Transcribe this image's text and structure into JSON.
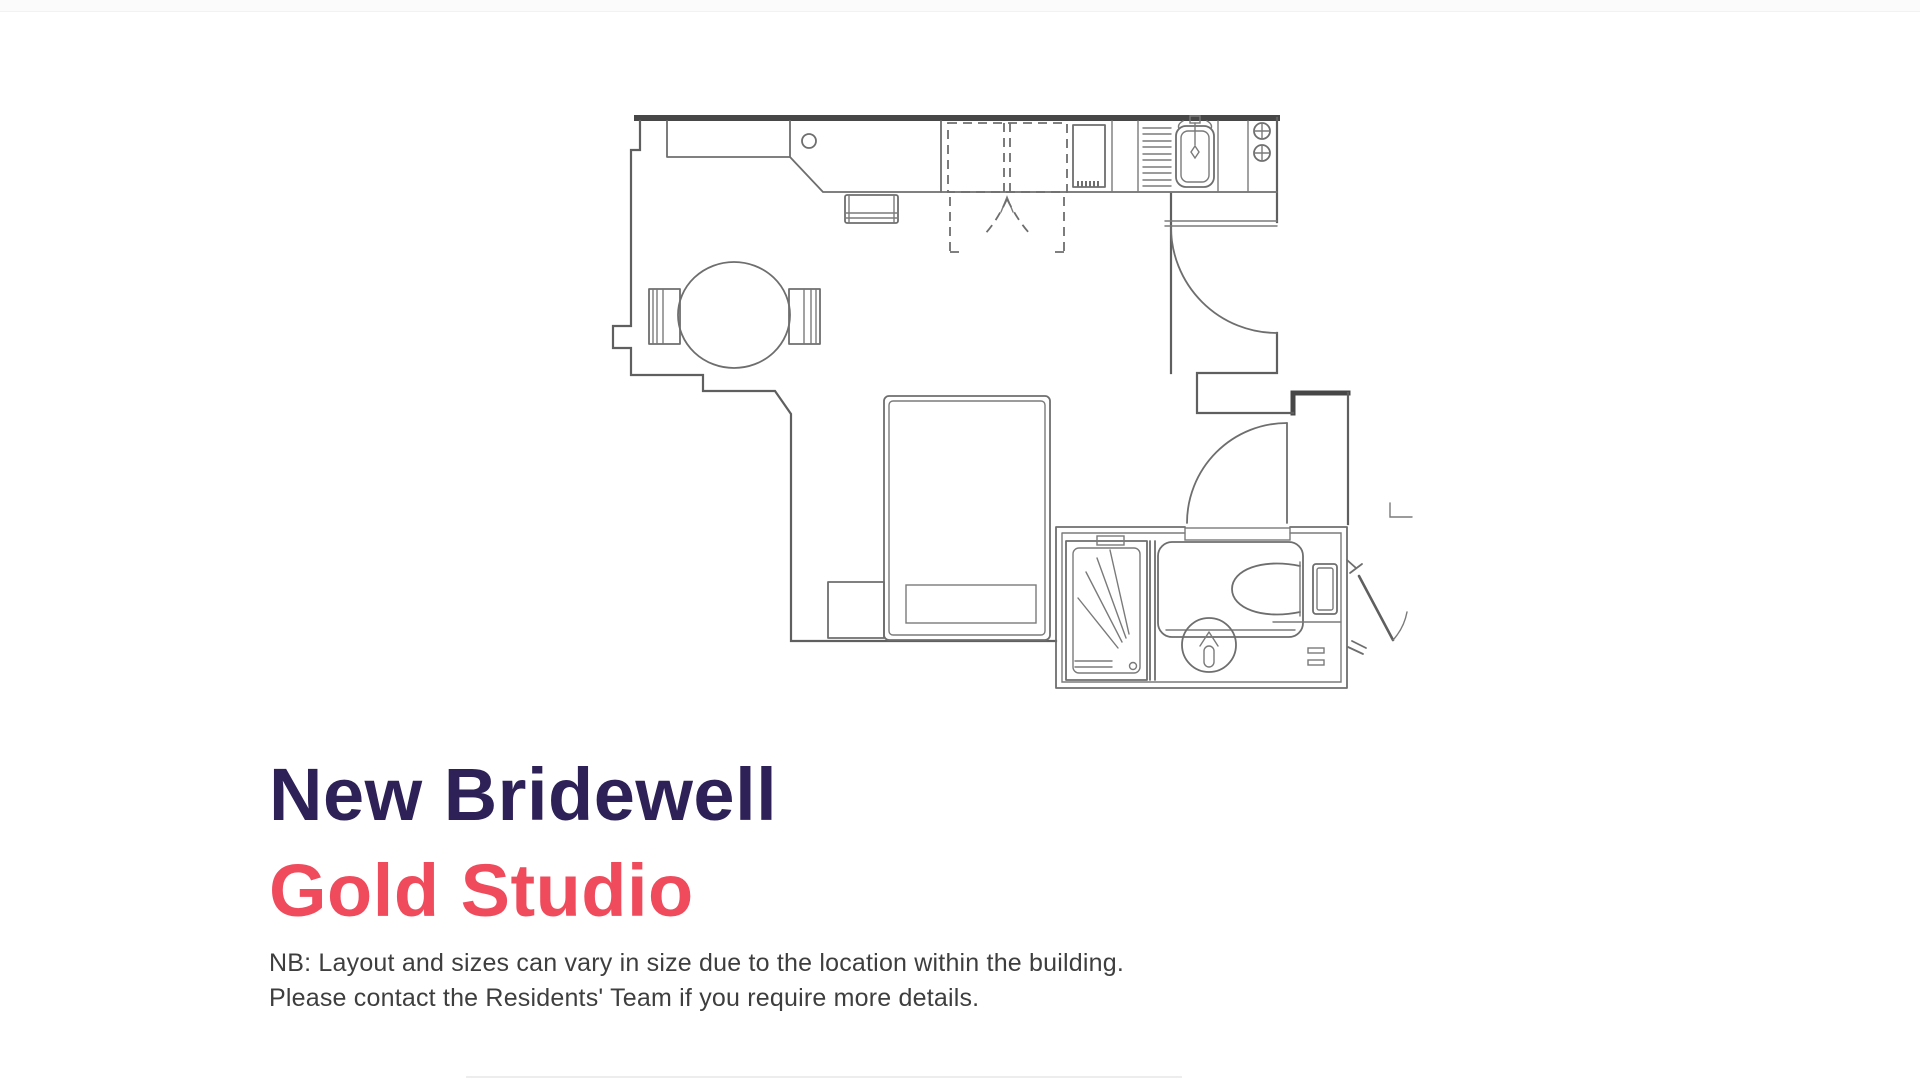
{
  "heading": {
    "building": "New Bridewell",
    "unit": "Gold Studio"
  },
  "note": {
    "line1": "NB: Layout and sizes can vary in size due to the location within the building.",
    "line2": "Please contact the Residents' Team if you require more details."
  },
  "colors": {
    "heading_primary": "#2e2157",
    "heading_accent": "#ef4b5c",
    "note_text": "#3e3e3e",
    "plan_wall": "#474747",
    "plan_line": "#6e6e6e",
    "background": "#ffffff"
  },
  "floorplan": {
    "type": "studio-apartment-plan",
    "fixtures": [
      "kitchen-counter",
      "desk",
      "desk-chair",
      "wardrobe-sliding-doors",
      "fridge",
      "draining-board",
      "kitchen-sink",
      "hob-two-burners",
      "dining-table",
      "dining-chair-left",
      "dining-chair-right",
      "bed",
      "bedside-table",
      "entry-door",
      "bathroom-door",
      "shower",
      "shower-screen",
      "toilet",
      "wash-basin",
      "cistern",
      "corridor-door"
    ]
  }
}
